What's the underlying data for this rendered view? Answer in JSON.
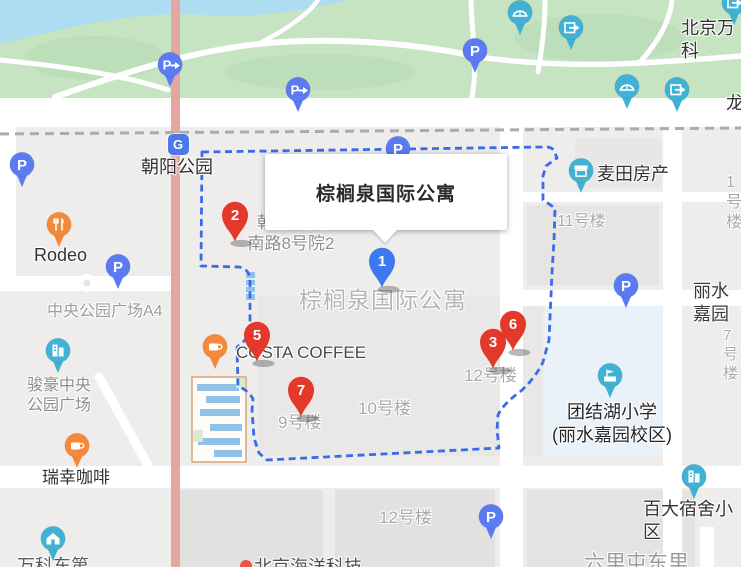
{
  "info_card": {
    "title": "棕榈泉国际公寓"
  },
  "colors": {
    "boundary_dash": "#3a6ce6",
    "red_pin": "#e2392b",
    "blue_pin": "#3e78ee",
    "teal_poi": "#41b2d4",
    "orange_poi": "#f5893b",
    "parking_blue": "#5b7bf2",
    "park_green": "#c6e3c2",
    "water": "#aeddf2",
    "school_block": "#e8f2f8",
    "trunk_road": "#e3a7a1"
  },
  "map": {
    "labels": [
      {
        "name": "station-chaoyang-park",
        "text": "朝阳公园",
        "x": 141,
        "y": 156,
        "size": 18,
        "color": "#2e2e2e"
      },
      {
        "name": "poi-rodeo",
        "text": "Rodeo",
        "x": 34,
        "y": 244,
        "size": 18,
        "color": "#333333"
      },
      {
        "name": "area-central-park-plaza-a4",
        "text": "中央公园广场A4",
        "x": 47,
        "y": 302,
        "size": 16,
        "color": "#9b9b99"
      },
      {
        "name": "area-junhao-central-park-plaza",
        "text": "骏豪中央\n公园广场",
        "x": 59,
        "y": 376,
        "size": 16,
        "color": "#8c8c8a",
        "align": "center"
      },
      {
        "name": "poi-luckin-coffee",
        "text": "瑞幸咖啡",
        "x": 42,
        "y": 467,
        "size": 17,
        "color": "#333333"
      },
      {
        "name": "poi-vanke-east",
        "text": "万科东第",
        "x": 17,
        "y": 555,
        "size": 18,
        "color": "#5a5a5a"
      },
      {
        "name": "address-courtyard",
        "text": "朝阳公园\n南路8号院2",
        "x": 291,
        "y": 212,
        "size": 17,
        "color": "#8e8e8c",
        "align": "center"
      },
      {
        "name": "area-palm-springs",
        "text": "棕榈泉国际公寓",
        "x": 299,
        "y": 286,
        "size": 23,
        "color": "#b4b4b2",
        "ls": 1
      },
      {
        "name": "poi-costa-coffee",
        "text": "COSTA COFFEE",
        "x": 236,
        "y": 342,
        "size": 17,
        "color": "#4a4a4a"
      },
      {
        "name": "building-9",
        "text": "9号楼",
        "x": 278,
        "y": 412,
        "size": 17,
        "color": "#a9a9a7"
      },
      {
        "name": "building-10",
        "text": "10号楼",
        "x": 358,
        "y": 398,
        "size": 17,
        "color": "#a9a9a7"
      },
      {
        "name": "building-12-north",
        "text": "12号楼",
        "x": 464,
        "y": 365,
        "size": 17,
        "color": "#a9a9a7"
      },
      {
        "name": "building-12-south",
        "text": "12号楼",
        "x": 379,
        "y": 507,
        "size": 17,
        "color": "#a9a9a7"
      },
      {
        "name": "building-11",
        "text": "11号楼",
        "x": 557,
        "y": 212,
        "size": 16,
        "color": "#a9a9a7"
      },
      {
        "name": "building-1",
        "text": "1号楼",
        "x": 726,
        "y": 173,
        "size": 16,
        "color": "#a9a9a7"
      },
      {
        "name": "area-lishui-jiayuan",
        "text": "丽水嘉园",
        "x": 693,
        "y": 280,
        "size": 18,
        "color": "#3a3a3a"
      },
      {
        "name": "building-7",
        "text": "7号楼",
        "x": 723,
        "y": 327,
        "size": 15,
        "color": "#a9a9a7"
      },
      {
        "name": "poi-maitian-realty",
        "text": "麦田房产",
        "x": 597,
        "y": 163,
        "size": 18,
        "color": "#333333"
      },
      {
        "name": "poi-tuanjiehu-school",
        "text": "团结湖小学\n(丽水嘉园校区)",
        "x": 612,
        "y": 401,
        "size": 18,
        "color": "#262626",
        "align": "center"
      },
      {
        "name": "area-baida-dormitory",
        "text": "百大宿舍小区",
        "x": 643,
        "y": 498,
        "size": 18,
        "color": "#333333"
      },
      {
        "name": "area-liulitun-east",
        "text": "六里屯东里",
        "x": 584,
        "y": 551,
        "size": 21,
        "color": "#9b9b99"
      },
      {
        "name": "poi-beijing-haiyang",
        "text": "北京海洋科技",
        "x": 254,
        "y": 556,
        "size": 18,
        "color": "#4f4f4f"
      },
      {
        "name": "area-beijing-vanke",
        "text": "北京万科",
        "x": 681,
        "y": 17,
        "size": 18,
        "color": "#333333"
      },
      {
        "name": "area-long-partial",
        "text": "龙",
        "x": 726,
        "y": 92,
        "size": 18,
        "color": "#333333"
      }
    ],
    "numbered_pins": [
      {
        "name": "result-pin-2",
        "number": "2",
        "x": 235,
        "y": 242,
        "color": "#e2392b"
      },
      {
        "name": "result-pin-5",
        "number": "5",
        "x": 257,
        "y": 362,
        "color": "#e2392b"
      },
      {
        "name": "result-pin-7",
        "number": "7",
        "x": 301,
        "y": 417,
        "color": "#e2392b"
      },
      {
        "name": "result-pin-6",
        "number": "6",
        "x": 513,
        "y": 351,
        "color": "#e2392b"
      },
      {
        "name": "result-pin-3",
        "number": "3",
        "x": 493,
        "y": 369,
        "color": "#e2392b"
      },
      {
        "name": "result-pin-1-selected",
        "number": "1",
        "x": 382,
        "y": 288,
        "color": "#3e78ee"
      }
    ],
    "poi_pins": [
      {
        "name": "subway-station-icon",
        "icon": "subway",
        "x": 178,
        "y": 144,
        "color": "#4b79e8",
        "glyph": "G"
      },
      {
        "name": "parking-entrance-icon-park-west",
        "icon": "parking-arrow",
        "x": 170,
        "y": 64,
        "color": "#5b7bf2"
      },
      {
        "name": "parking-icon-left-edge",
        "icon": "parking",
        "x": 22,
        "y": 164,
        "color": "#5b7bf2"
      },
      {
        "name": "parking-entrance-icon-park-mid",
        "icon": "parking-arrow",
        "x": 298,
        "y": 89,
        "color": "#5b7bf2"
      },
      {
        "name": "parking-icon-park-east",
        "icon": "parking",
        "x": 475,
        "y": 50,
        "color": "#5b7bf2"
      },
      {
        "name": "parking-icon-north-gate",
        "icon": "parking",
        "x": 398,
        "y": 148,
        "color": "#5b7bf2"
      },
      {
        "name": "parking-icon-plaza",
        "icon": "parking",
        "x": 118,
        "y": 266,
        "color": "#5b7bf2"
      },
      {
        "name": "parking-icon-east-street",
        "icon": "parking",
        "x": 626,
        "y": 285,
        "color": "#5b7bf2"
      },
      {
        "name": "parking-icon-south",
        "icon": "parking",
        "x": 491,
        "y": 516,
        "color": "#5b7bf2"
      },
      {
        "name": "bridge-icon-park-a",
        "icon": "bridge",
        "x": 520,
        "y": 12,
        "color": "#41b2d4"
      },
      {
        "name": "gate-icon-park-a",
        "icon": "gate",
        "x": 571,
        "y": 27,
        "color": "#41b2d4"
      },
      {
        "name": "bridge-icon-park-b",
        "icon": "bridge",
        "x": 627,
        "y": 86,
        "color": "#41b2d4"
      },
      {
        "name": "gate-icon-park-b",
        "icon": "gate",
        "x": 677,
        "y": 89,
        "color": "#41b2d4"
      },
      {
        "name": "gate-icon-corner",
        "icon": "gate",
        "x": 734,
        "y": 2,
        "color": "#41b2d4"
      },
      {
        "name": "shop-icon-maitian",
        "icon": "shop",
        "x": 581,
        "y": 170,
        "color": "#41b2d4"
      },
      {
        "name": "building-icon-junhao",
        "icon": "building",
        "x": 58,
        "y": 350,
        "color": "#41b2d4"
      },
      {
        "name": "school-icon-tuanjiehu",
        "icon": "school",
        "x": 610,
        "y": 375,
        "color": "#41b2d4"
      },
      {
        "name": "building-icon-baida",
        "icon": "building",
        "x": 694,
        "y": 476,
        "color": "#41b2d4"
      },
      {
        "name": "home-icon-vanke",
        "icon": "home",
        "x": 53,
        "y": 538,
        "color": "#41b2d4"
      },
      {
        "name": "restaurant-icon-rodeo",
        "icon": "restaurant",
        "x": 59,
        "y": 224,
        "color": "#f5893b"
      },
      {
        "name": "coffee-icon-costa",
        "icon": "coffee",
        "x": 215,
        "y": 346,
        "color": "#f5893b"
      },
      {
        "name": "coffee-icon-luckin",
        "icon": "coffee",
        "x": 77,
        "y": 445,
        "color": "#f5893b"
      },
      {
        "name": "poi-dot-partial",
        "icon": "dot",
        "x": 246,
        "y": 566,
        "color": "#e85848"
      }
    ]
  }
}
